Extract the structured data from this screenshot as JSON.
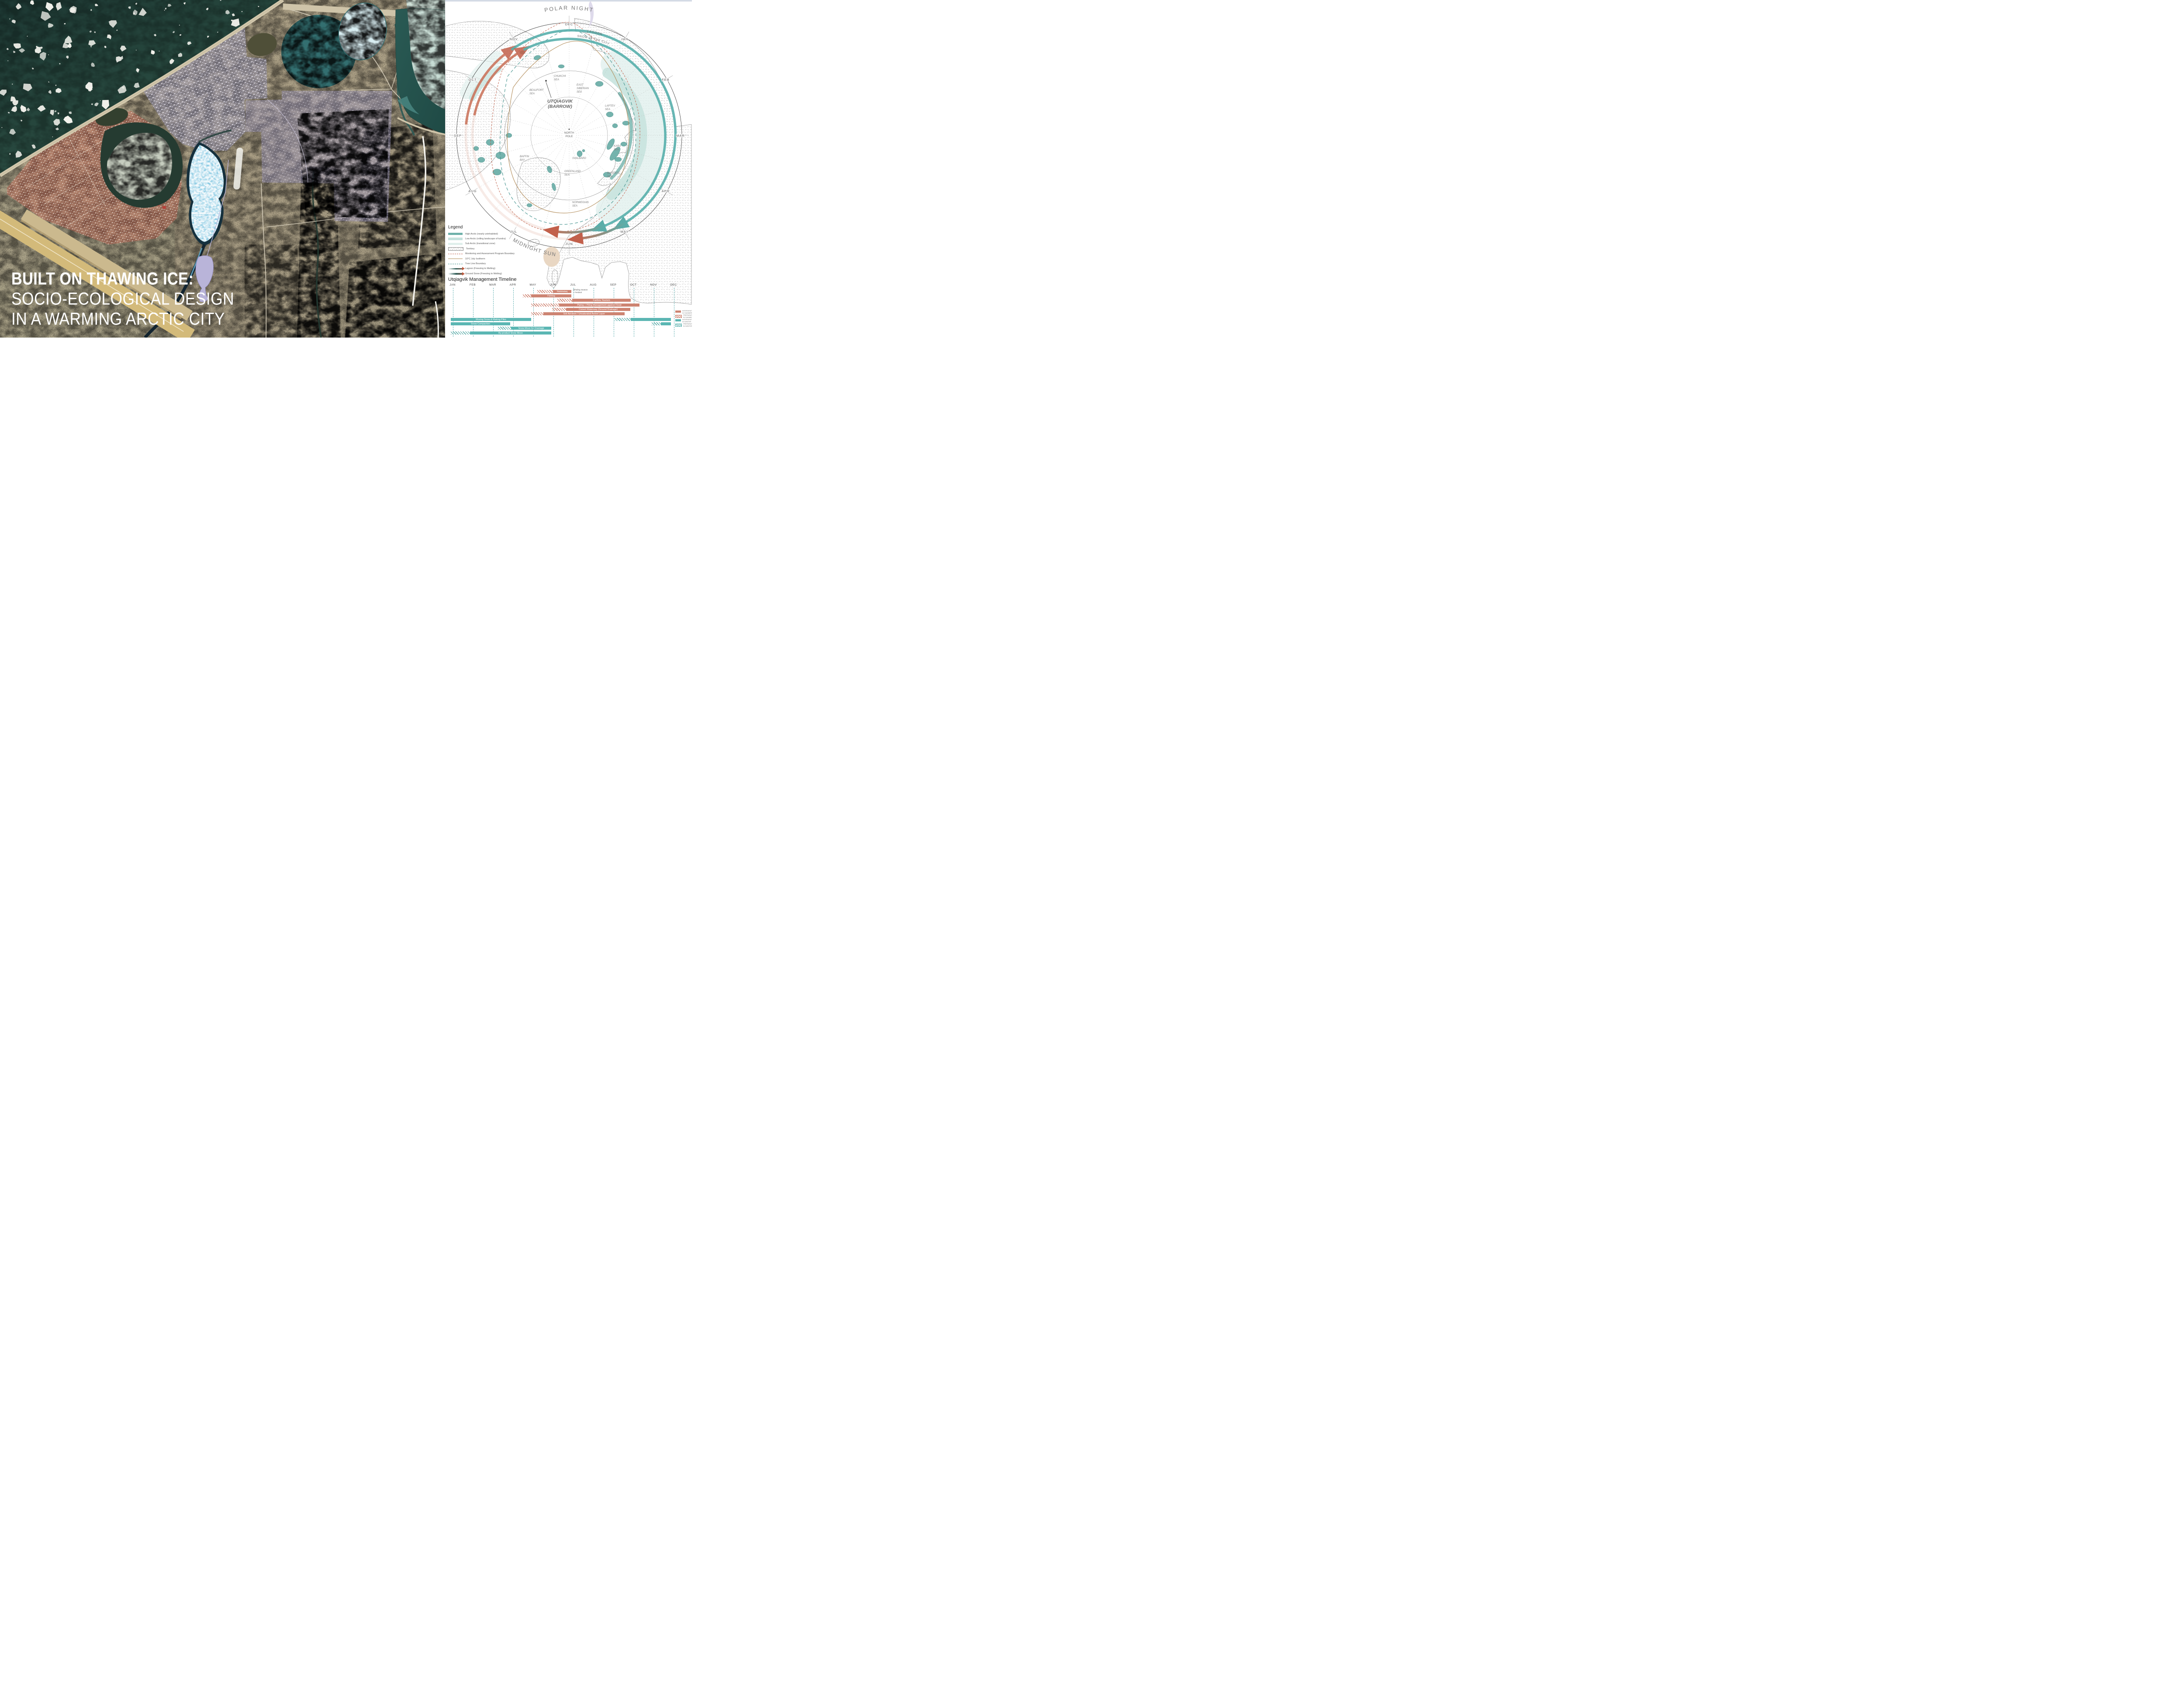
{
  "title": {
    "line1": "BUILT ON THAWING ICE:",
    "line2": "SOCIO-ECOLOGICAL DESIGN",
    "line3": "IN A WARMING ARCTIC CITY"
  },
  "polar_diagram": {
    "polar_night": "POLAR NIGHT",
    "midnight_sun": "MIDNIGHT SUN",
    "lagoon_ring": "LAGOON",
    "snow_ring": "SNOW IN THE CITY",
    "months": [
      "JAN",
      "FEB",
      "MAR",
      "APR",
      "MAY",
      "JUN",
      "JUL",
      "AUG",
      "SEP",
      "OCT",
      "NOV",
      "DEC"
    ],
    "city_line1": "UTQIAGVIK",
    "city_line2": "(BARROW)",
    "north_pole_line1": "NORTH",
    "north_pole_line2": "POLE",
    "seas": {
      "chukchi1": "CHUKCHI",
      "chukchi2": "SEA",
      "beaufort1": "BEAUFORT",
      "beaufort2": "SEA",
      "east_siberian1": "EAST",
      "east_siberian2": "SIBERIAN",
      "east_siberian3": "SEA",
      "laptev1": "LAPTEV",
      "laptev2": "SEA",
      "kara1": "KARA",
      "kara2": "SEA",
      "barents1": "BARENTS",
      "barents2": "SEA",
      "norwegian1": "NORWEGIAN",
      "norwegian2": "SEA",
      "greenland1": "GREENLAND",
      "greenland2": "SEA",
      "baffin1": "BAFFIN",
      "baffin2": "BAY",
      "svalbard": "SVALBARD"
    }
  },
  "legend": {
    "title": "Legend",
    "items": [
      {
        "label": "High Arctic (nearly uninhabited)",
        "type": "swatch",
        "color": "#6fb1aa"
      },
      {
        "label": "Low Arctic (rolling landscape of tundra)",
        "type": "swatch",
        "color": "#c6e1dd"
      },
      {
        "label": "Sub Arctic (transitional zone)",
        "type": "swatch",
        "color": "#e0efec"
      },
      {
        "label": "Territory",
        "type": "hatch"
      },
      {
        "label": "Monitoring and Assessment Program Boundary",
        "type": "dashed-red",
        "color": "#c0604a"
      },
      {
        "label": "10°C July Isotherm",
        "type": "solid-brown",
        "color": "#b08a55"
      },
      {
        "label": "Tree Line Boundary",
        "type": "dashed-teal",
        "color": "#3f908c"
      },
      {
        "label": "Lagoon (Freezing to Melting)",
        "type": "gradient-arrow"
      },
      {
        "label": "Ground Snow (Freezing to Melting)",
        "type": "gradient-arrow"
      }
    ]
  },
  "timeline": {
    "title": "Utqiagvik Management Timeline",
    "months": [
      "JAN",
      "FEB",
      "MAR",
      "APR",
      "MAY",
      "JUN",
      "JUL",
      "AUG",
      "SEP",
      "OCT",
      "NOV",
      "DEC"
    ],
    "note": {
      "line1": "Whaling Season",
      "line2": "+ Festival"
    },
    "tasks": [
      {
        "label": "Nalukataq",
        "season": "summer",
        "prep": [
          4.2,
          5.0
        ],
        "active": [
          5.0,
          5.9
        ]
      },
      {
        "label": "Fishing",
        "season": "summer",
        "prep": [
          3.5,
          3.9
        ],
        "active": [
          3.9,
          5.9
        ]
      },
      {
        "label": "Caribou Tourism",
        "season": "summer",
        "prep": [
          5.2,
          5.95
        ],
        "active": [
          5.95,
          8.85
        ]
      },
      {
        "label": "Piping + Piling Management against Flood",
        "season": "summer",
        "prep": [
          3.9,
          5.3
        ],
        "active": [
          5.3,
          9.3
        ]
      },
      {
        "label": "Culvert Waterway (Ground Drainage)",
        "season": "summer",
        "prep": [
          4.95,
          5.65
        ],
        "active": [
          5.65,
          8.85
        ]
      },
      {
        "label": "Soil Aeration / Unsaturated Active Layer",
        "season": "summer",
        "prep": [
          3.9,
          4.5
        ],
        "active": [
          4.5,
          8.55
        ]
      },
      {
        "label": "Moving Snow & Making Piles",
        "season": "winter",
        "active": [
          -0.1,
          3.9
        ],
        "prep2": [
          8.05,
          8.85
        ],
        "active2": [
          8.85,
          10.85
        ]
      },
      {
        "label": "Snow Compaction",
        "season": "winter",
        "active": [
          -0.1,
          2.85
        ],
        "prep2": [
          9.9,
          10.35
        ],
        "active2": [
          10.35,
          10.85
        ]
      },
      {
        "label": "Snow Move for Drainage",
        "season": "winter",
        "prep": [
          2.25,
          2.9
        ],
        "active": [
          2.9,
          4.9
        ]
      },
      {
        "label": "By-product Snow Move",
        "season": "winter",
        "prep": [
          -0.1,
          0.85
        ],
        "active": [
          0.85,
          4.9
        ]
      }
    ],
    "legend": [
      {
        "line1": "INTERVENTION",
        "line2": "IN SUMMER",
        "type": "solid-summer"
      },
      {
        "line1": "PREPARATION",
        "line2": "IN SUMMER",
        "type": "hatch-summer"
      },
      {
        "line1": "INTERVENTION",
        "line2": "IN WINTER",
        "type": "solid-winter"
      },
      {
        "line1": "PREPARATION",
        "line2": "IN WINTER",
        "type": "hatch-winter"
      }
    ]
  },
  "colors": {
    "summer_bar": "#cd8472",
    "winter_bar": "#5bb6b3",
    "ring_teal": "#58b0ac",
    "ring_salmon": "#c96f56",
    "ocean": "#24443e",
    "tundra": "#b3a78d",
    "red_zone": "#c25a4a",
    "purple_zone": "#9494be",
    "sun": "#e9d7c3"
  }
}
